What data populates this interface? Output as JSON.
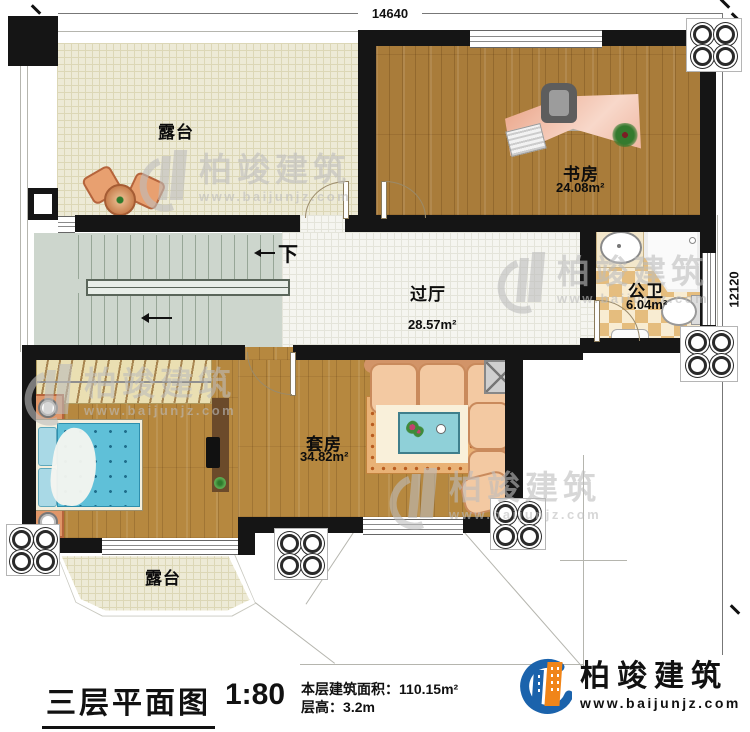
{
  "dimensions": {
    "top": "14640",
    "right": "12120"
  },
  "rooms": {
    "terrace_top": {
      "label": "露台"
    },
    "study": {
      "label": "书房",
      "area": "24.08m²"
    },
    "hall": {
      "label": "过厅",
      "area": "28.57m²"
    },
    "bath": {
      "label": "公卫",
      "area": "6.04m²"
    },
    "suite": {
      "label": "套房",
      "area": "34.82m²"
    },
    "terrace_bottom": {
      "label": "露台"
    }
  },
  "stairs": {
    "down_label": "下"
  },
  "titleblock": {
    "title": "三层平面图",
    "scale": "1:80",
    "area_label": "本层建筑面积：",
    "area_value": "110.15m²",
    "height_label": "层高：",
    "height_value": "3.2m"
  },
  "brand": {
    "name": "柏竣建筑",
    "website": "www.baijunjz.com"
  },
  "watermark": {
    "name": "柏竣建筑",
    "website": "www.baijunjz.com"
  },
  "colors": {
    "brand_blue": "#1b63ac",
    "brand_orange": "#f08519",
    "wall": "#151515"
  }
}
